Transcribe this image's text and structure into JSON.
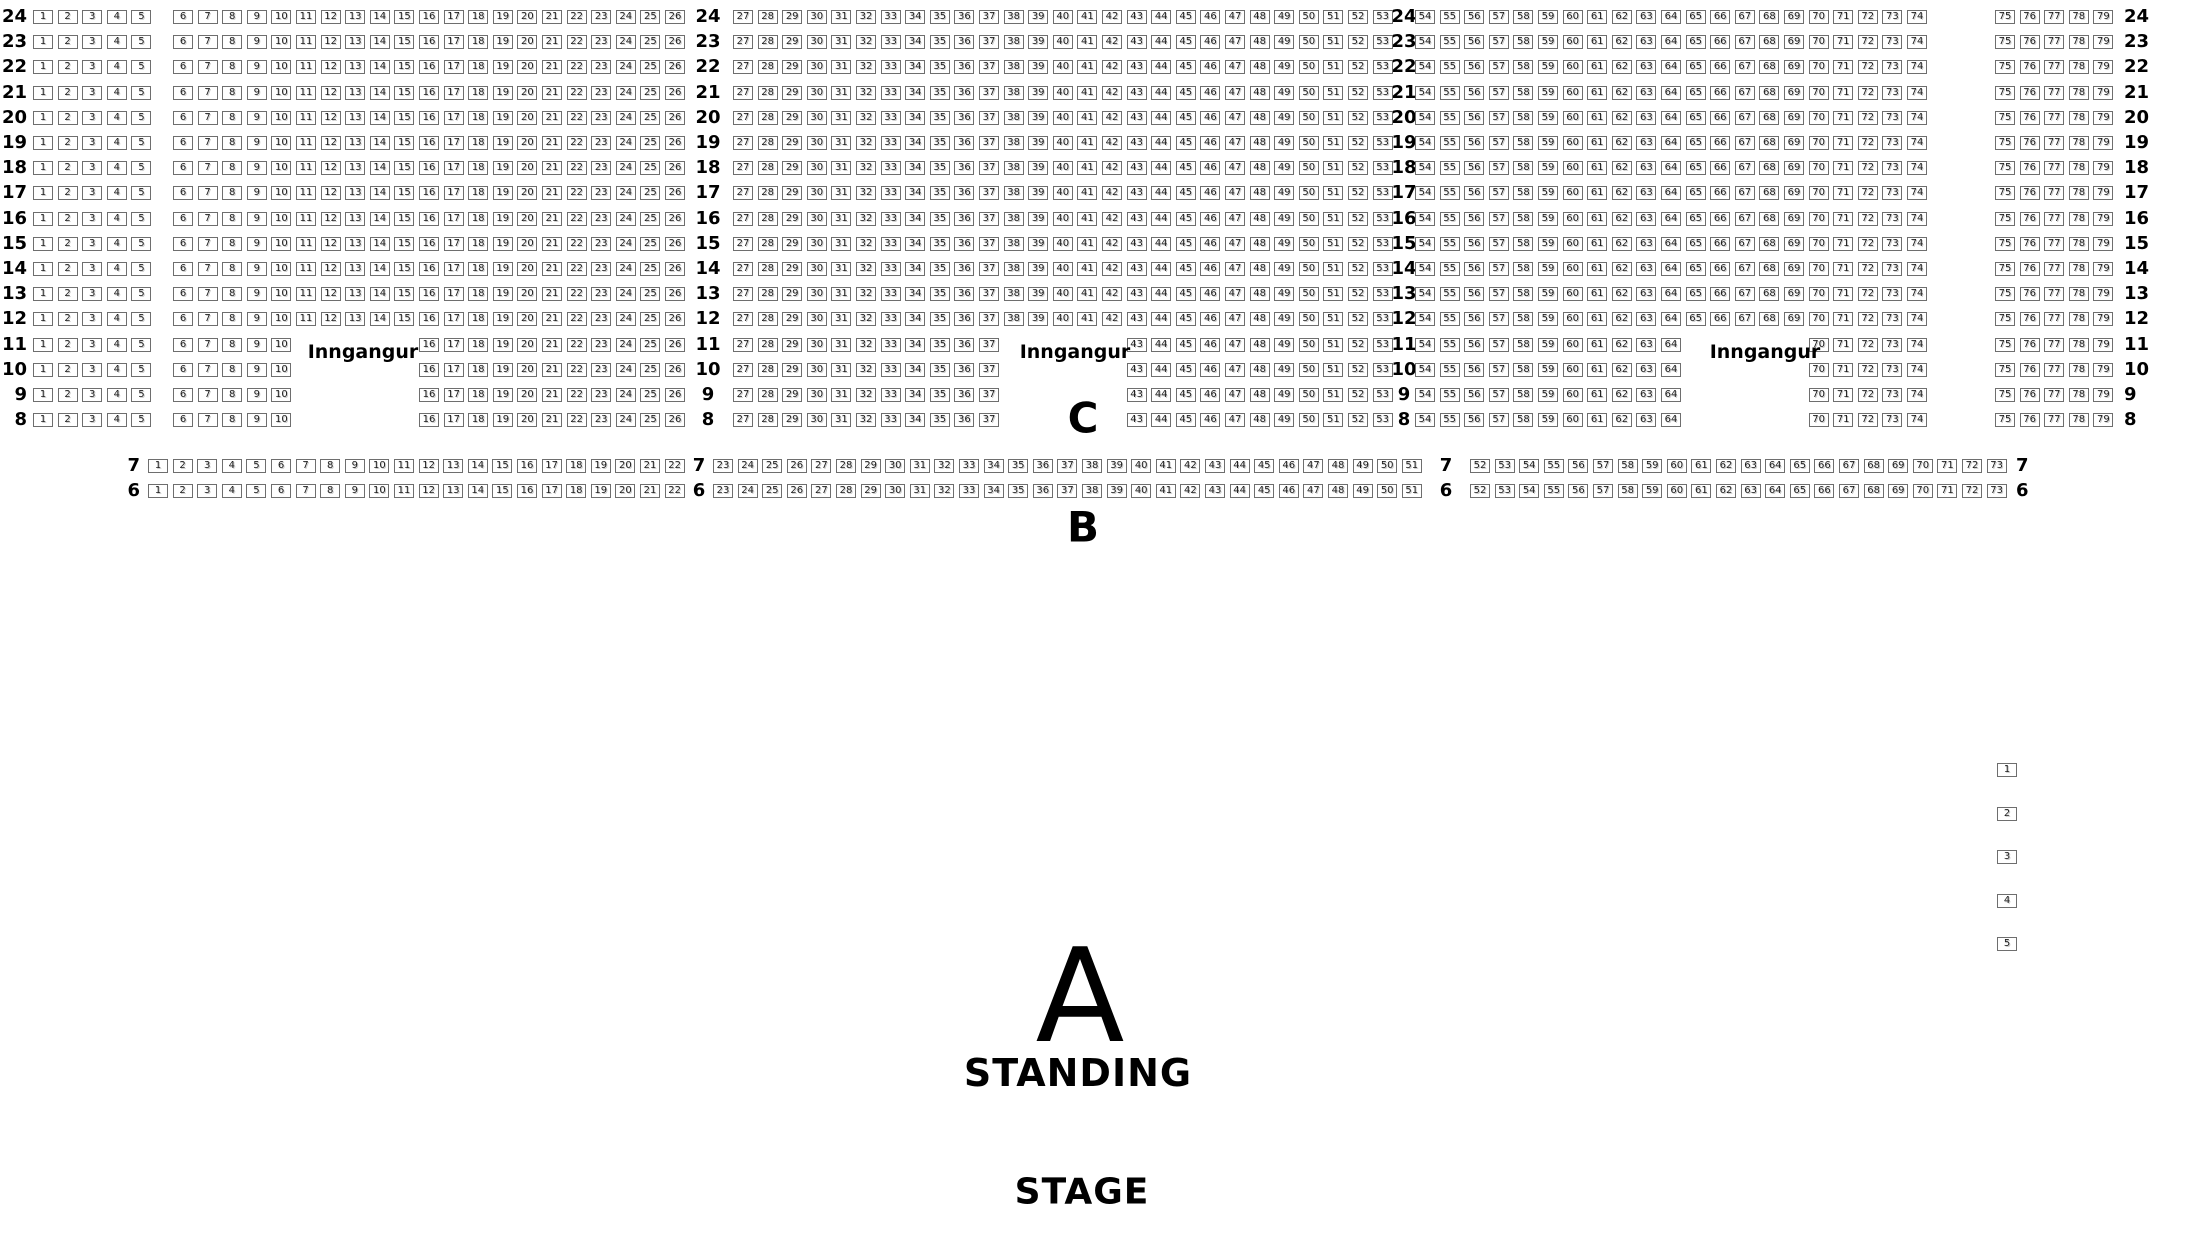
{
  "labels": {
    "entrance": "Inngangur",
    "section_a": "A",
    "section_a_sub": "STANDING",
    "section_b": "B",
    "section_c": "C",
    "stage": "STAGE"
  },
  "colors": {
    "background": "#ffffff",
    "seat_border": "#6e6e6e",
    "text": "#000000"
  },
  "seat_map": {
    "row_groups": [
      {
        "name": "rear-full-rows",
        "rows": [
          24,
          23,
          22,
          21,
          20,
          19,
          18,
          17,
          16,
          15,
          14,
          13,
          12
        ],
        "segments": [
          [
            1,
            5
          ],
          [
            6,
            26
          ],
          [
            27,
            53
          ],
          [
            54,
            74
          ],
          [
            75,
            79
          ]
        ]
      },
      {
        "name": "rear-split-rows",
        "rows": [
          11,
          10,
          9,
          8
        ],
        "segments": [
          [
            1,
            5
          ],
          [
            6,
            10
          ],
          [
            16,
            26
          ],
          [
            27,
            37
          ],
          [
            43,
            53
          ],
          [
            54,
            64
          ],
          [
            70,
            74
          ],
          [
            75,
            79
          ]
        ]
      },
      {
        "name": "front-rows",
        "rows": [
          7,
          6
        ],
        "segments": [
          [
            1,
            22
          ],
          [
            23,
            51
          ],
          [
            52,
            73
          ]
        ]
      }
    ],
    "side_seats": [
      1,
      2,
      3,
      4,
      5
    ]
  }
}
